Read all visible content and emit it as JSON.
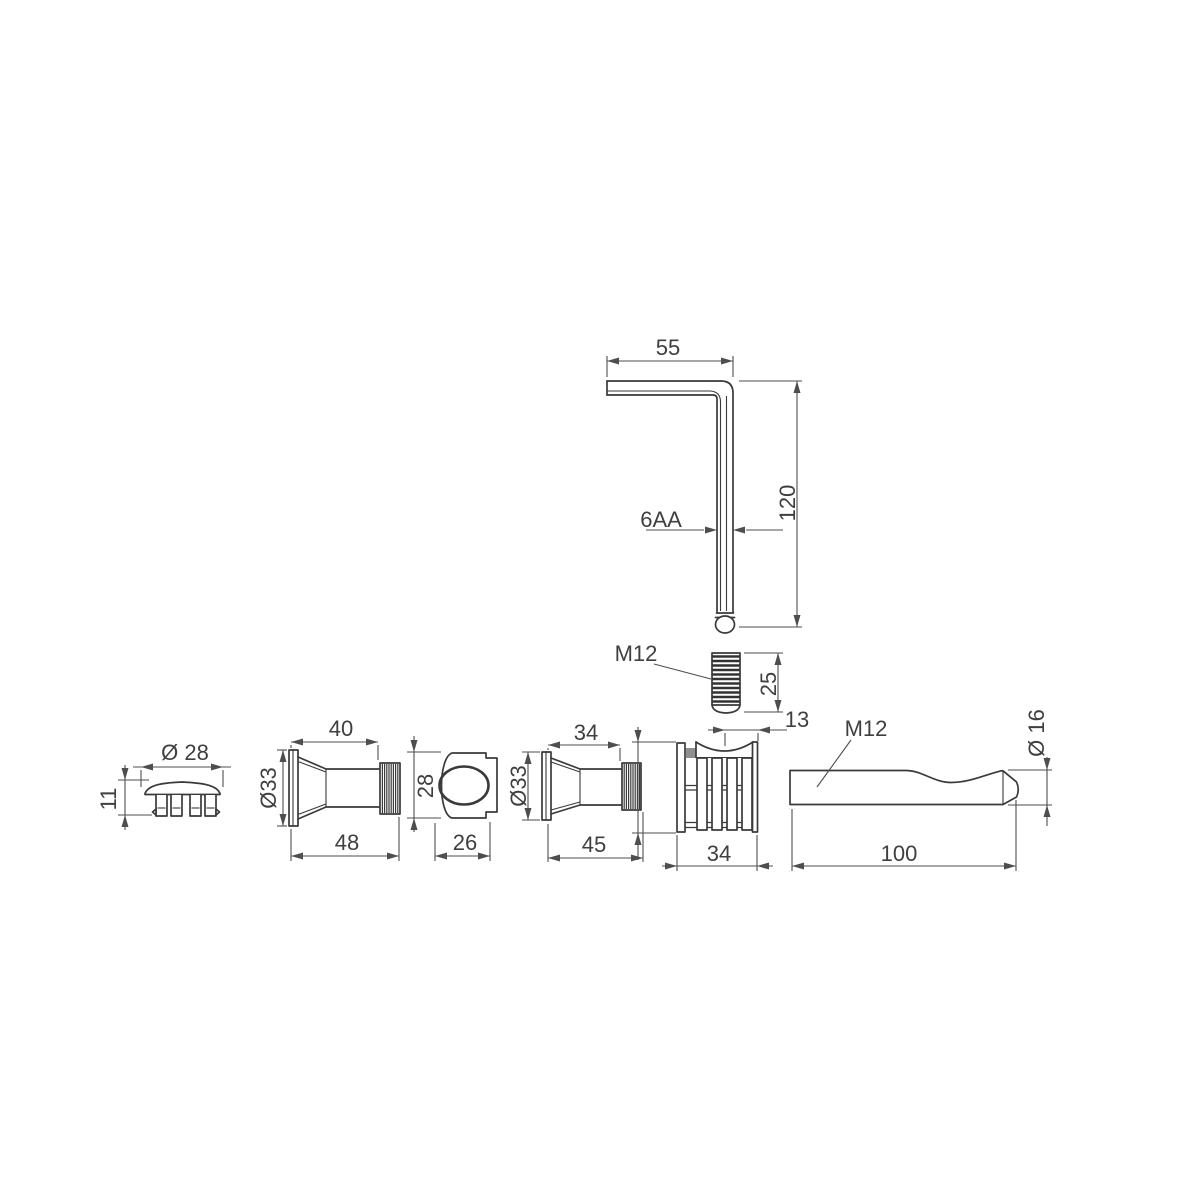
{
  "drawing": {
    "background": "#ffffff",
    "line_color": "#3a3a3a",
    "dimension_color": "#4e4e4e",
    "text_color": "#3f3f3f",
    "parts": {
      "hex_key": {
        "length_label": "55",
        "height_label": "120",
        "size_label": "6AA"
      },
      "set_screw": {
        "thread_label": "M12",
        "length_label": "25"
      },
      "cover_cap": {
        "diameter_label": "Ø 28",
        "height_label": "11"
      },
      "sleeve_large": {
        "width_top_label": "40",
        "diameter_label": "Ø33",
        "width_bottom_label": "48"
      },
      "cam_housing": {
        "height_label": "28",
        "width_label": "26"
      },
      "sleeve_small": {
        "width_top_label": "34",
        "diameter_label": "Ø33",
        "width_bottom_label": "45"
      },
      "expansion_dowel": {
        "top_label": "13",
        "width_label": "34"
      },
      "lever_handle": {
        "thread_label": "M12",
        "length_label": "100",
        "diameter_label": "Ø 16"
      }
    }
  }
}
